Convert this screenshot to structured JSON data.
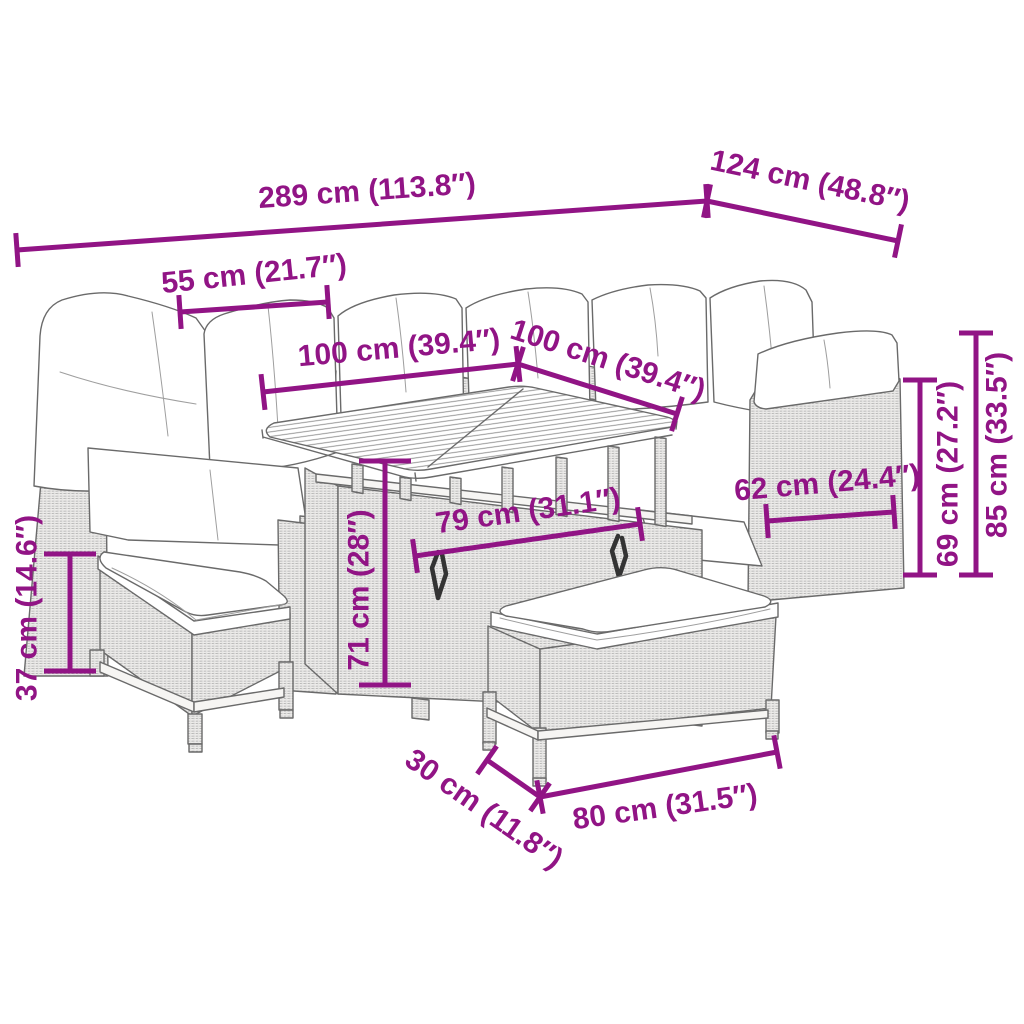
{
  "canvas": {
    "width": 1024,
    "height": 1024,
    "background": "#ffffff"
  },
  "style": {
    "dimension_color": "#911485",
    "line_color": "#6a6a6a",
    "dimension_stroke_width": 5,
    "label_font_size": 30
  },
  "figure": {
    "type": "product-dimension-diagram",
    "subject": "poly-rattan garden lounge set with corner sofa, cushions, dining table and two benches"
  },
  "dimensions": [
    {
      "id": "sofa-length",
      "label": "289 cm (113.8″)",
      "x1": 17,
      "y1": 250,
      "x2": 707,
      "y2": 201,
      "lx": 367,
      "ly": 191,
      "rot": -4,
      "tick": 34
    },
    {
      "id": "sofa-depth-right",
      "label": "124 cm (48.8″)",
      "x1": 707,
      "y1": 201,
      "x2": 898,
      "y2": 241,
      "lx": 810,
      "ly": 181,
      "rot": 12,
      "tick": 34
    },
    {
      "id": "seat-width-left",
      "label": "55 cm (21.7″)",
      "x1": 180,
      "y1": 312,
      "x2": 328,
      "y2": 302,
      "lx": 254,
      "ly": 274,
      "rot": -6,
      "tick": 34
    },
    {
      "id": "table-width",
      "label": "100 cm (39.4″)",
      "x1": 263,
      "y1": 392,
      "x2": 518,
      "y2": 364,
      "lx": 399,
      "ly": 348,
      "rot": -5,
      "tick": 36
    },
    {
      "id": "table-depth",
      "label": "100 cm (39.4″)",
      "x1": 518,
      "y1": 364,
      "x2": 677,
      "y2": 414,
      "lx": 608,
      "ly": 360,
      "rot": 18,
      "tick": 36
    },
    {
      "id": "seat-depth-right",
      "label": "62 cm (24.4″)",
      "x1": 767,
      "y1": 521,
      "x2": 894,
      "y2": 512,
      "lx": 827,
      "ly": 483,
      "rot": -5,
      "tick": 34
    },
    {
      "id": "seat-height-back",
      "label": "69 cm (27.2″)",
      "x1": 920,
      "y1": 380,
      "x2": 920,
      "y2": 575,
      "lx": 948,
      "ly": 474,
      "rot": -90,
      "tick": 34
    },
    {
      "id": "sofa-height",
      "label": "85 cm (33.5″)",
      "x1": 976,
      "y1": 333,
      "x2": 976,
      "y2": 575,
      "lx": 997,
      "ly": 445,
      "rot": -90,
      "tick": 34
    },
    {
      "id": "bench-height",
      "label": "37 cm (14.6″)",
      "x1": 70,
      "y1": 554,
      "x2": 70,
      "y2": 671,
      "lx": 27,
      "ly": 608,
      "rot": -90,
      "tick": 52
    },
    {
      "id": "table-height",
      "label": "71 cm (28″)",
      "x1": 385,
      "y1": 461,
      "x2": 385,
      "y2": 685,
      "lx": 359,
      "ly": 590,
      "rot": -90,
      "tick": 52
    },
    {
      "id": "table-base-width",
      "label": "79 cm (31.1″)",
      "x1": 415,
      "y1": 556,
      "x2": 640,
      "y2": 524,
      "lx": 528,
      "ly": 511,
      "rot": -8,
      "tick": 34
    },
    {
      "id": "bench-depth",
      "label": "30 cm (11.8″)",
      "x1": 487,
      "y1": 760,
      "x2": 540,
      "y2": 797,
      "lx": 484,
      "ly": 809,
      "rot": 35,
      "tick": 34
    },
    {
      "id": "bench-length",
      "label": "80 cm (31.5″)",
      "x1": 540,
      "y1": 797,
      "x2": 777,
      "y2": 752,
      "lx": 665,
      "ly": 807,
      "rot": -8,
      "tick": 34
    }
  ]
}
